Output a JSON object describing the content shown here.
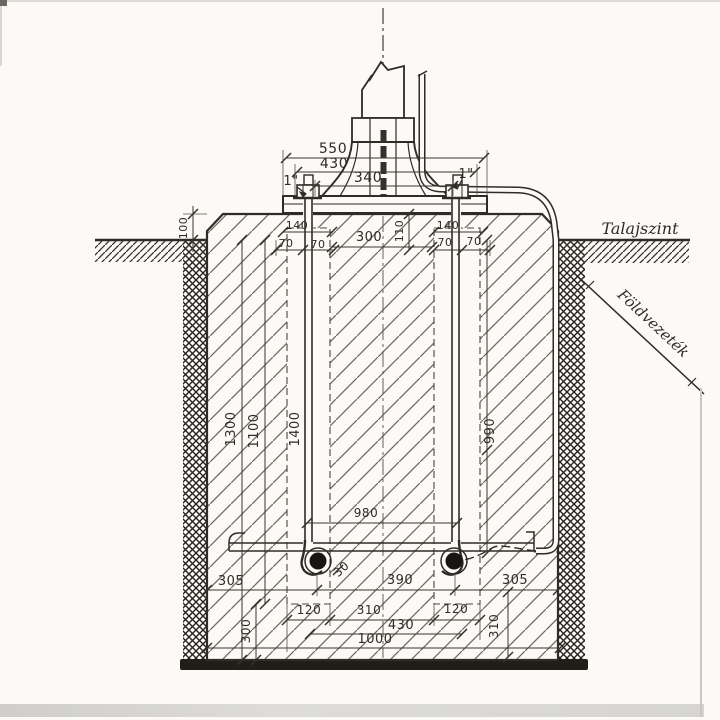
{
  "drawing": {
    "annotations": {
      "ground_level": "Talajszint",
      "earth_conductor": "Földvezeték"
    },
    "dimensions": {
      "top_width_outer": "550",
      "top_width_mid": "430",
      "top_width_inner": "340",
      "anchor_bolt_left_size": "1\"",
      "anchor_bolt_right_size": "1\"",
      "plate_left_offset": "140",
      "plate_right_offset": "140",
      "plate_left_half_a": "70",
      "plate_left_half_b": "70",
      "plate_right_half_a": "70",
      "plate_right_half_b": "70",
      "bolt_clear_spacing": "300",
      "plate_depth": "110",
      "height_above_ground": "100",
      "depth_total": "1300",
      "depth_channel": "1100",
      "bolt_length": "1400",
      "conduit_depth": "990",
      "bolt_spacing_bottom": "980",
      "hook_offset": "30",
      "bottom_left_margin": "305",
      "bottom_center_span": "390",
      "bottom_right_margin": "305",
      "channel_width_left": "120",
      "channel_clear_span": "310",
      "channel_width_right": "120",
      "anchor_frame_span": "430",
      "foundation_width": "1000",
      "bottom_block_height": "300",
      "bottom_right_height": "310"
    }
  }
}
